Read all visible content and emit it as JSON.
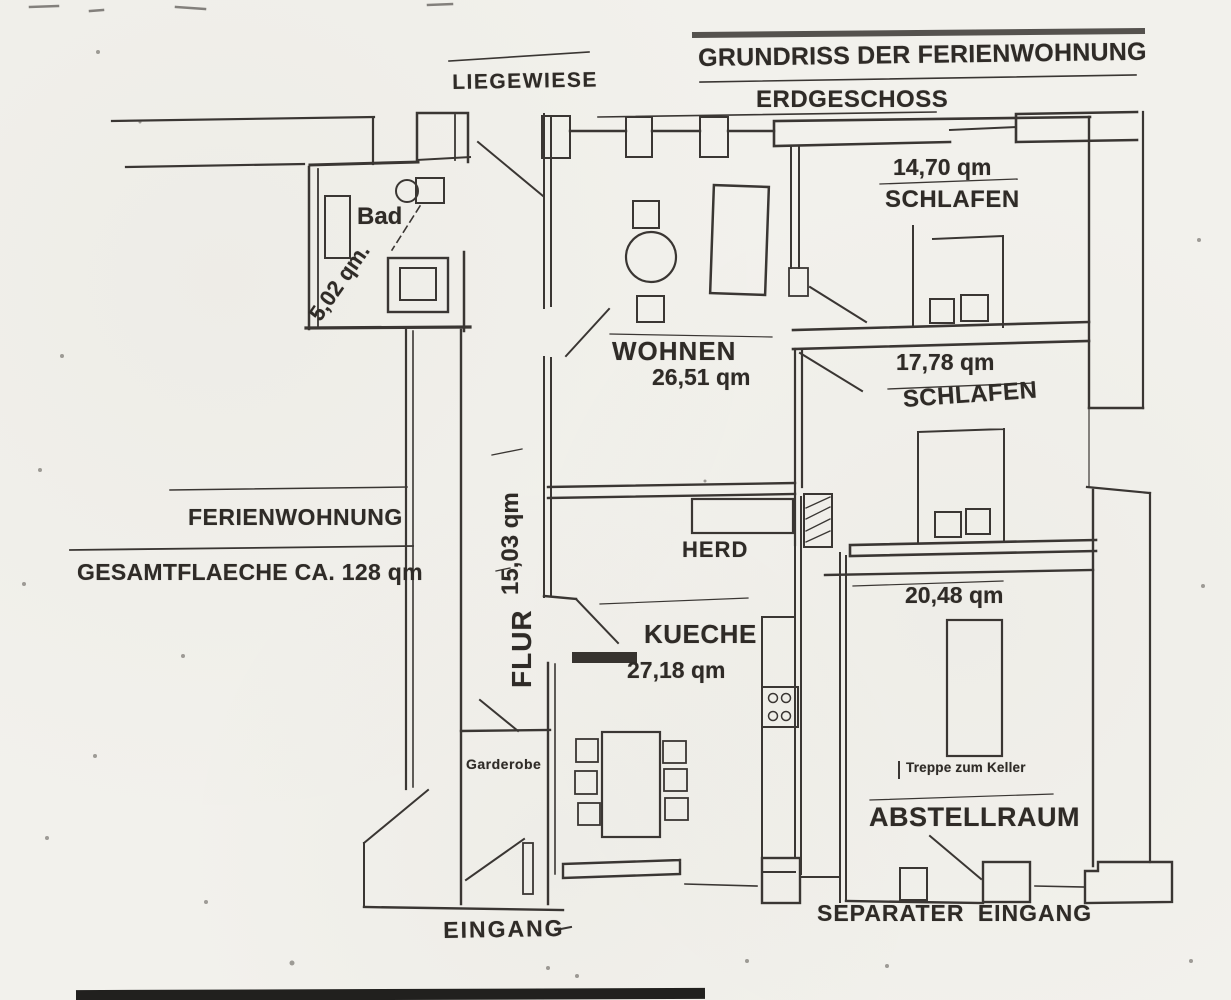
{
  "meta": {
    "paper_color": "#f2f1ec",
    "ink_color": "#3a3633",
    "document_type": "scanned floor plan"
  },
  "header": {
    "title": "GRUNDRISS DER FERIENWOHNUNG",
    "subtitle": "ERDGESCHOSS"
  },
  "outside": {
    "liegewiese_label": "LIEGEWIESE"
  },
  "summary": {
    "name": "FERIENWOHNUNG",
    "total_area": "GESAMTFLAECHE CA. 128 qm"
  },
  "rooms": {
    "bad": {
      "name": "Bad",
      "area": "5,02 qm."
    },
    "schlafen1": {
      "name": "SCHLAFEN",
      "area": "14,70 qm"
    },
    "schlafen2": {
      "name": "SCHLAFEN",
      "area": "17,78 qm"
    },
    "wohnen": {
      "name": "WOHNEN",
      "area": "26,51 qm"
    },
    "flur": {
      "name": "FLUR",
      "area": "15,03 qm"
    },
    "kueche": {
      "name": "KUECHE",
      "area": "27,18 qm"
    },
    "abstellraum": {
      "name": "ABSTELLRAUM",
      "area": "20,48 qm"
    }
  },
  "features": {
    "herd": "HERD",
    "garderobe": "Garderobe",
    "treppe_zum_keller": "Treppe zum Keller"
  },
  "entrances": {
    "eingang": "EINGANG",
    "separater_eingang": "SEPARATER EINGANG"
  }
}
